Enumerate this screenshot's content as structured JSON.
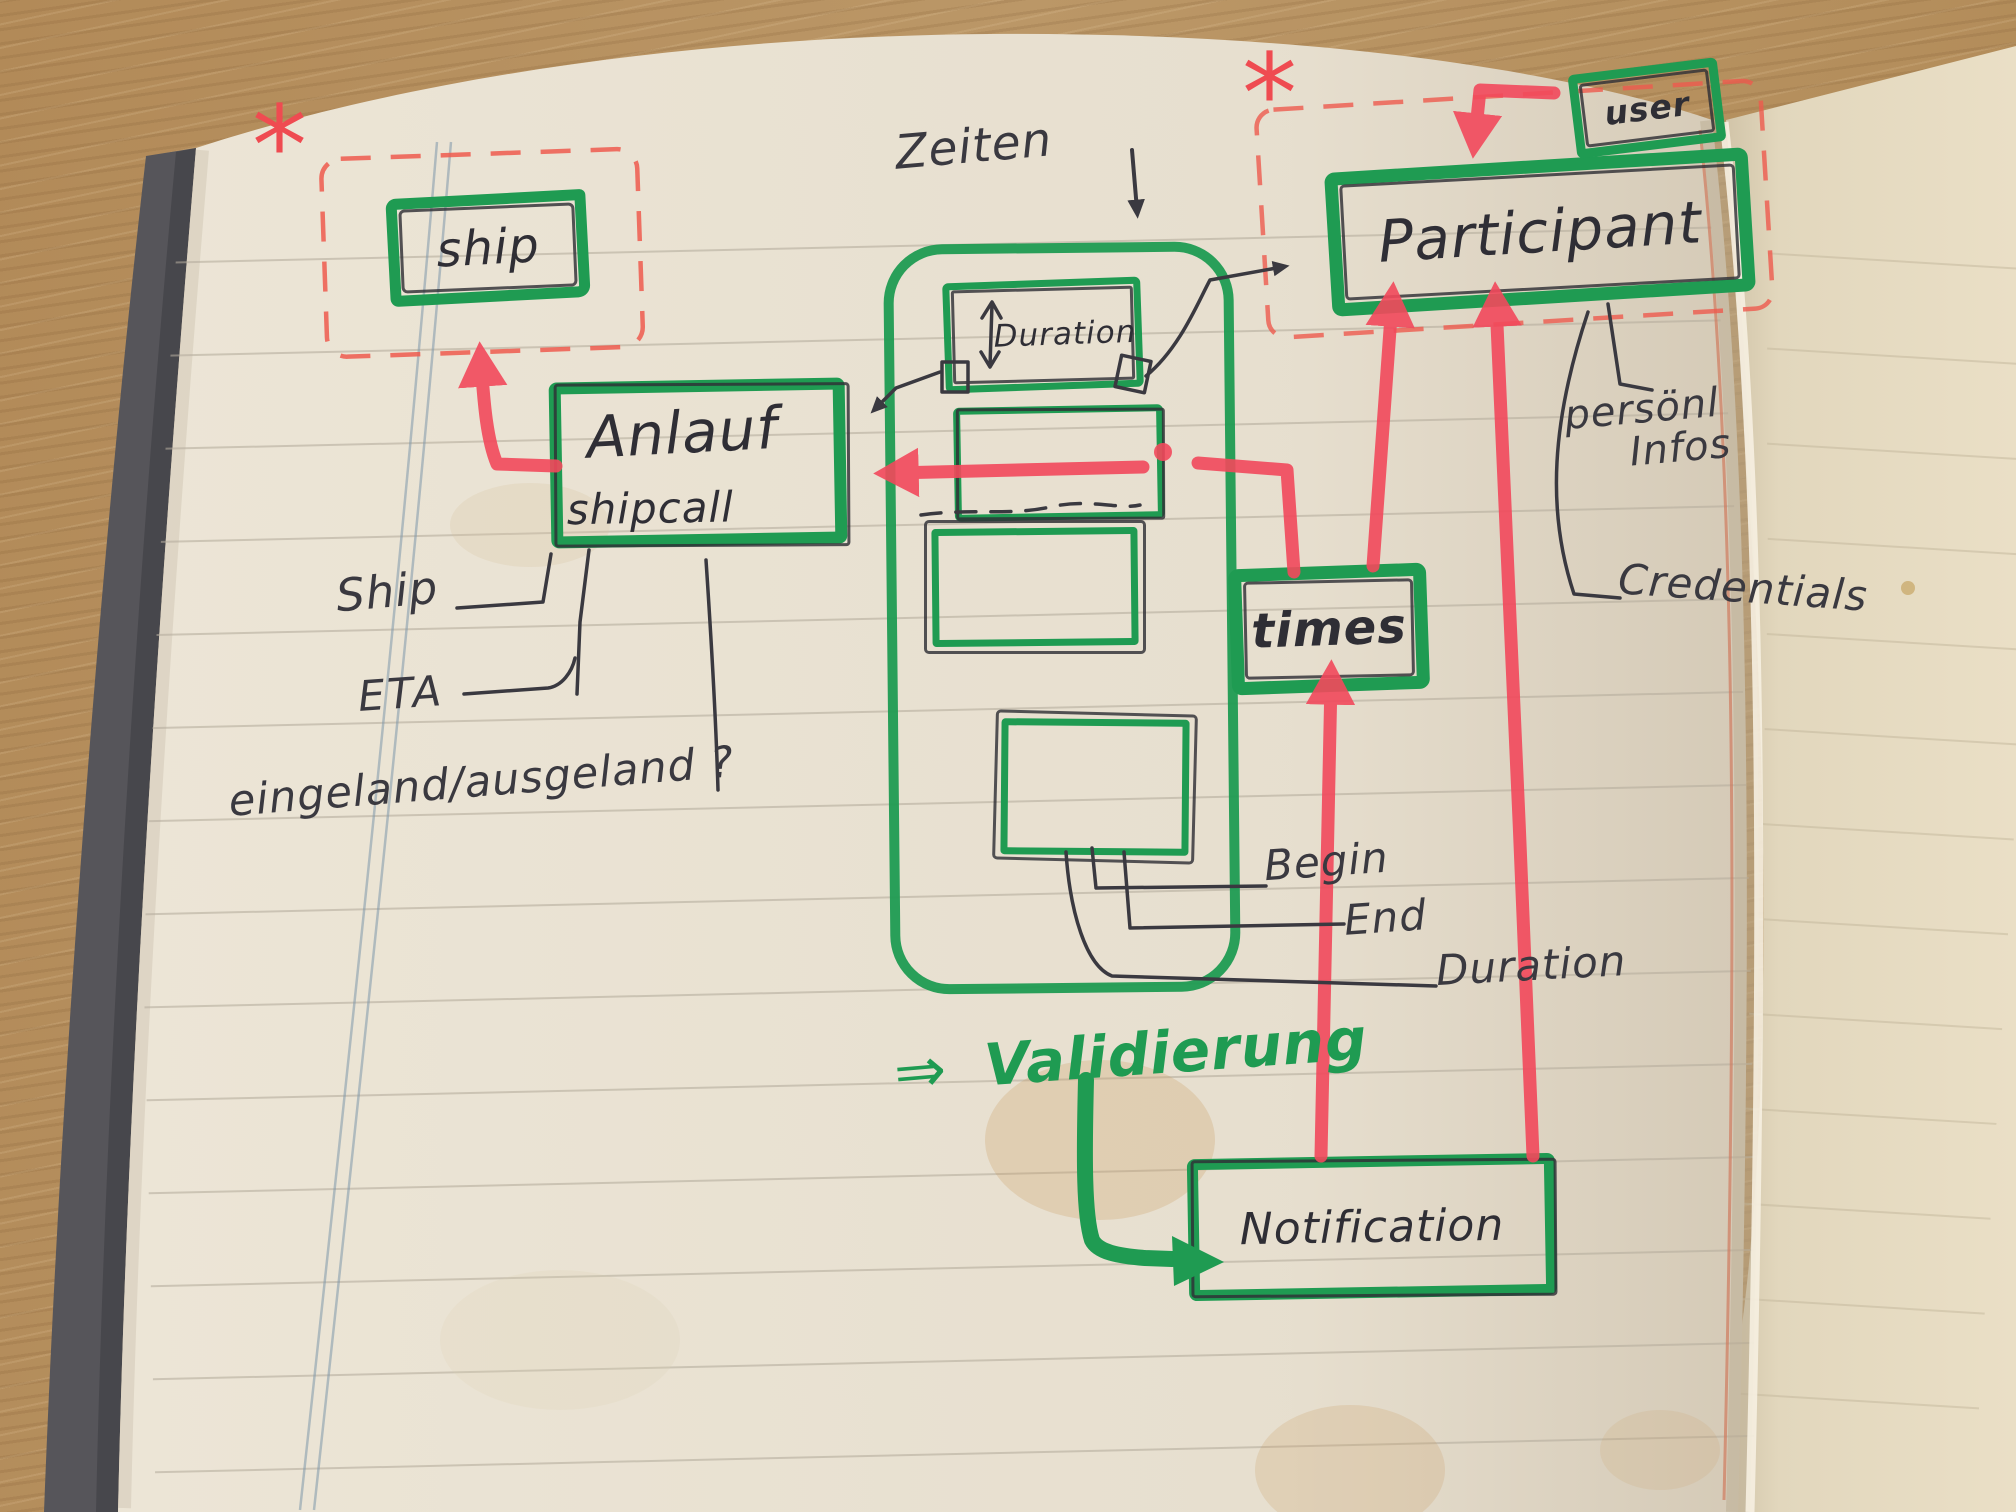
{
  "entities": {
    "ship": "ship",
    "anlauf": "Anlauf",
    "anlauf_sub": "shipcall",
    "duration": "Duration",
    "participant": "Participant",
    "user": "user",
    "times": "times",
    "notification": "Notification"
  },
  "annotations": {
    "zeiten": "Zeiten",
    "ship_attr": "Ship",
    "eta": "ETA",
    "inout": "eingeland/ausgeland ?",
    "begin": "Begin",
    "end": "End",
    "duration_attr": "Duration",
    "persoenl_1": "persönl",
    "persoenl_2": "Infos",
    "credentials": "Credentials",
    "validierung_arrow": "⇒",
    "validierung": "Validierung",
    "asterisk": "*"
  },
  "colors": {
    "marker_green": "#1f9b52",
    "marker_red": "#f2495c",
    "dashed_red": "#ee5a4e",
    "ink": "#3a3940",
    "page": "#ece5d6",
    "wood": "#b6925f"
  }
}
